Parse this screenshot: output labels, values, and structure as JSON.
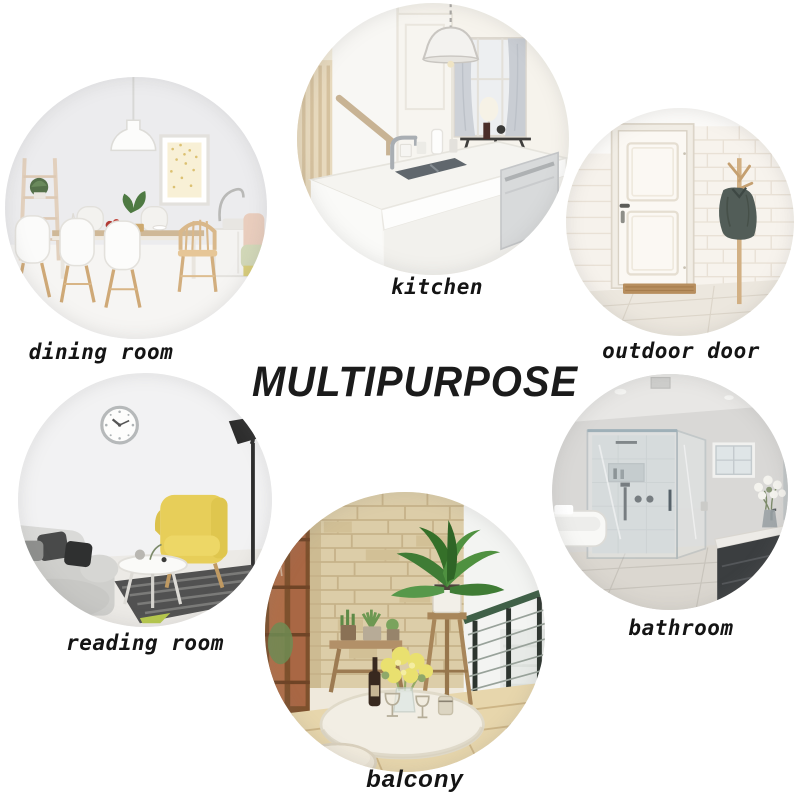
{
  "title": "MULTIPURPOSE",
  "sections": [
    {
      "id": "dining_room",
      "label": "dining room",
      "alt": "white dining room with pendant lamp, speckled wall art, ladder shelf, table and chairs"
    },
    {
      "id": "kitchen",
      "label": "kitchen",
      "alt": "white kitchen island with sink, faucet, pendant lamp and window"
    },
    {
      "id": "outdoor_door",
      "label": "outdoor door",
      "alt": "white paneled entry door with brick wall, coat rack with jacket and doormat"
    },
    {
      "id": "reading_room",
      "label": "reading room",
      "alt": "reading corner with wall clock, black floor lamp, yellow wingback chair, gray sofa, round table and striped rug"
    },
    {
      "id": "bathroom",
      "label": "bathroom",
      "alt": "gray bathroom with glass shower, window, bathtub and dark vanity with flowers"
    },
    {
      "id": "balcony",
      "label": "balcony",
      "alt": "balcony with stone wall, tall green plant on stand, bench with small pots, white round table with flowers, wine and railing"
    }
  ],
  "colors": {
    "background": "#ffffff",
    "text": "#141414",
    "title": "#1b1b1b"
  }
}
